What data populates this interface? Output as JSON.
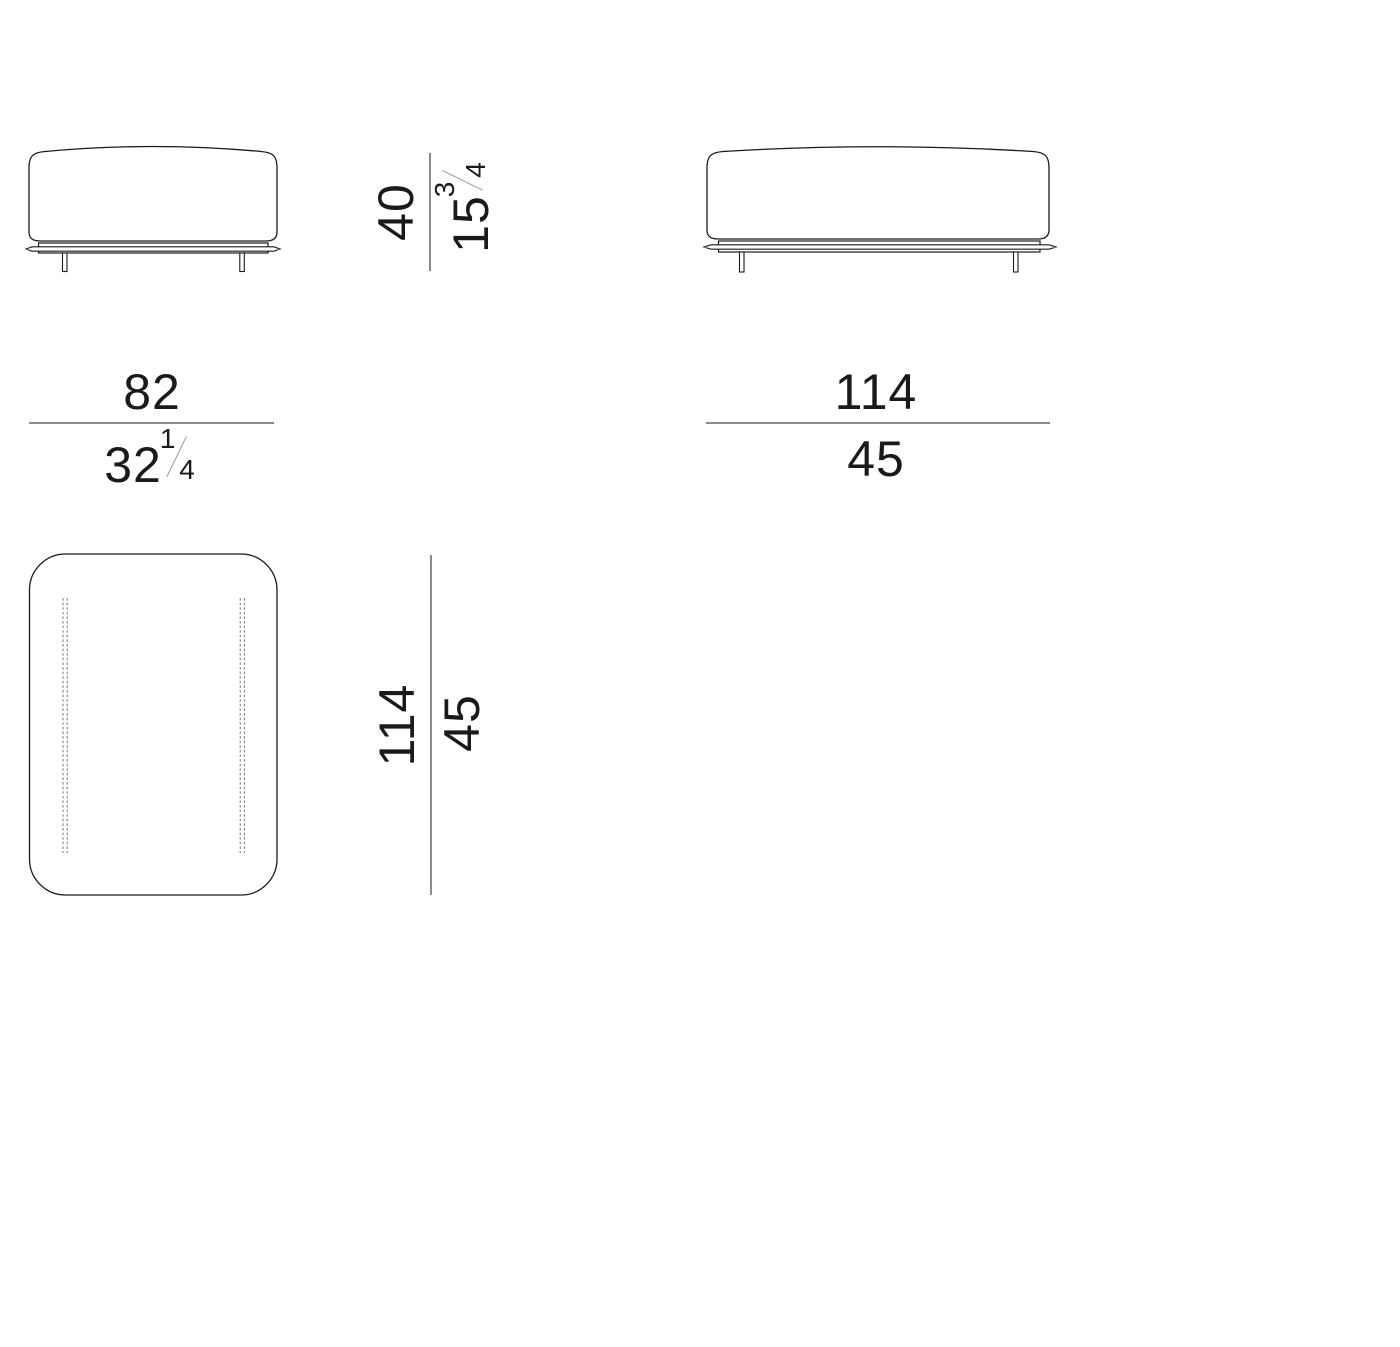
{
  "drawing_type": "furniture dimension diagram",
  "dimensions": {
    "height": {
      "cm": "40",
      "inches_whole": "15",
      "inches_numerator": "3",
      "inches_denominator": "4"
    },
    "small_width": {
      "cm": "82",
      "inches_whole": "32",
      "inches_numerator": "1",
      "inches_denominator": "4"
    },
    "large_width": {
      "cm": "114",
      "inches": "45"
    },
    "depth": {
      "cm": "114",
      "inches": "45"
    }
  },
  "colors": {
    "outline": "#1a1a1a",
    "dimension_line": "#8c8c8c",
    "stitch": "#777777",
    "text": "#1a1a1a",
    "background": "#ffffff"
  }
}
